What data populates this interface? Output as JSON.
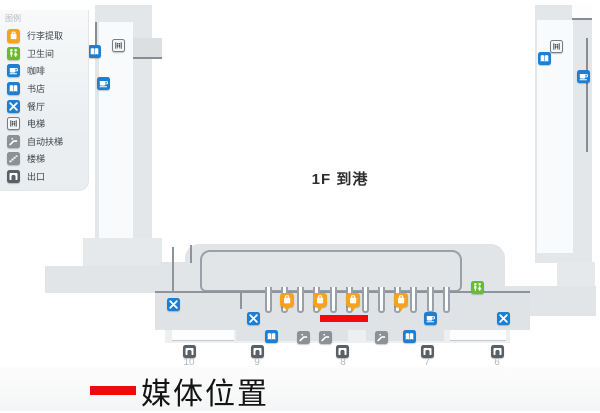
{
  "legend": {
    "title": "图例",
    "items": [
      {
        "id": "baggage",
        "label": "行李提取"
      },
      {
        "id": "toilet",
        "label": "卫生间"
      },
      {
        "id": "coffee",
        "label": "咖啡"
      },
      {
        "id": "bookstore",
        "label": "书店"
      },
      {
        "id": "restaurant",
        "label": "餐厅"
      },
      {
        "id": "elevator",
        "label": "电梯"
      },
      {
        "id": "escalator",
        "label": "自动扶梯"
      },
      {
        "id": "stairs",
        "label": "楼梯"
      },
      {
        "id": "exit",
        "label": "出口"
      }
    ]
  },
  "map": {
    "floor_label": "1F 到港",
    "markers": [
      {
        "type": "bookstore",
        "x": 88,
        "y": 45
      },
      {
        "type": "coffee",
        "x": 97,
        "y": 77
      },
      {
        "type": "elevator",
        "x": 112,
        "y": 39
      },
      {
        "type": "elevator",
        "x": 550,
        "y": 40
      },
      {
        "type": "bookstore",
        "x": 538,
        "y": 52
      },
      {
        "type": "coffee",
        "x": 577,
        "y": 70
      },
      {
        "type": "toilet",
        "x": 471,
        "y": 281
      },
      {
        "type": "restaurant",
        "x": 167,
        "y": 298
      },
      {
        "type": "restaurant",
        "x": 247,
        "y": 312
      },
      {
        "type": "coffee",
        "x": 424,
        "y": 312
      },
      {
        "type": "restaurant",
        "x": 497,
        "y": 312
      },
      {
        "type": "bookstore",
        "x": 265,
        "y": 330
      },
      {
        "type": "escalator",
        "x": 297,
        "y": 331
      },
      {
        "type": "escalator",
        "x": 319,
        "y": 331
      },
      {
        "type": "escalator",
        "x": 375,
        "y": 331
      },
      {
        "type": "bookstore",
        "x": 403,
        "y": 330
      },
      {
        "type": "baggage",
        "x": 280,
        "y": 293
      },
      {
        "type": "baggage",
        "x": 313,
        "y": 293
      },
      {
        "type": "baggage",
        "x": 346,
        "y": 293
      },
      {
        "type": "baggage",
        "x": 394,
        "y": 293
      },
      {
        "type": "exit",
        "x": 183,
        "y": 345
      },
      {
        "type": "exit",
        "x": 251,
        "y": 345
      },
      {
        "type": "exit",
        "x": 336,
        "y": 345
      },
      {
        "type": "exit",
        "x": 421,
        "y": 345
      },
      {
        "type": "exit",
        "x": 491,
        "y": 345
      }
    ],
    "gates": [
      {
        "label": "10",
        "x": 189
      },
      {
        "label": "9",
        "x": 257
      },
      {
        "label": "8",
        "x": 343
      },
      {
        "label": "7",
        "x": 427
      },
      {
        "label": "6",
        "x": 497
      }
    ],
    "media_line": {
      "x": 320,
      "y": 315,
      "width": 48,
      "height": 7,
      "color": "#F00A0A"
    }
  },
  "caption": {
    "label": "媒体位置",
    "swatch_color": "#F00A0A"
  },
  "colors": {
    "baggage": "#F7A21B",
    "toilet": "#69BB2F",
    "blue": "#1E7FD2",
    "gray_icon": "#8A9197",
    "exit_icon": "#596066"
  }
}
